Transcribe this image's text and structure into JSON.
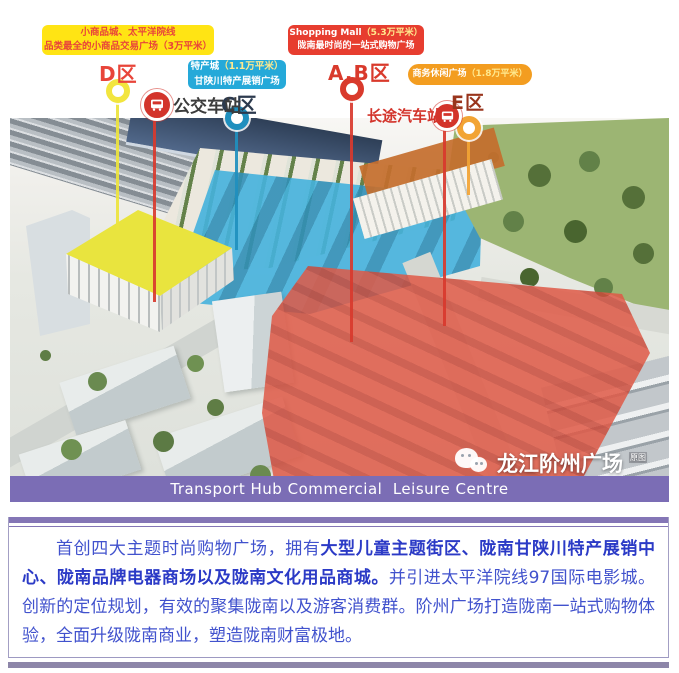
{
  "header_callouts": {
    "small_commodity": {
      "line1": "小商品城、太平洋院线",
      "line2": "品类最全的小商品交易广场（3万平米）",
      "bg": "#ffe414",
      "text_color": "#e8453a"
    },
    "shopping_mall": {
      "name": "Shopping Mall",
      "area": "（5.3万平米）",
      "line2": "陇南最时尚的一站式购物广场",
      "bg": "#e73d2f",
      "text_color": "#ffffff"
    },
    "specialty": {
      "name": "特产城",
      "area": "（1.1万平米）",
      "line2": "甘陕川特产展销广场",
      "bg": "#25a9d9",
      "text_color": "#ffffff"
    },
    "business": {
      "name": "商务休闲广场",
      "area": "（1.8万平米）",
      "bg": "#f39d20",
      "text_color": "#ffffff"
    }
  },
  "zones": {
    "d": {
      "label": "D区",
      "label_color": "#e8453a",
      "marker_color": "#f2e53e"
    },
    "c": {
      "label": "C区",
      "label_color": "#2c3a4e",
      "marker_color": "#1f8fbe"
    },
    "ab": {
      "label": "A.B区",
      "label_color": "#d93a2c",
      "marker_color": "#d93a2c"
    },
    "e": {
      "label": "E区",
      "label_color": "#99351d",
      "marker_color": "#f2a434"
    }
  },
  "stations": {
    "city_bus": {
      "label": "公交车站",
      "icon": "bus-icon",
      "icon_bg": "#d3342b",
      "label_color": "#3c3c3c"
    },
    "coach": {
      "label": "长途汽车站",
      "icon": "bus-icon",
      "icon_bg": "#d3342b",
      "label_color": "#d3342b"
    }
  },
  "photo": {
    "banner_text": "Transport Hub Commercial  Leisure Centre",
    "banner_bg": "#7b6db5",
    "watermark_icon": "wechat-icon",
    "watermark_text": "龙江阶州广场",
    "watermark_suffix": "原图"
  },
  "colors": {
    "accent_red": "#e73d2f",
    "accent_yellow": "#ffe414",
    "accent_cyan": "#25a9d9",
    "accent_orange": "#f39d20",
    "banner_purple": "#7b6db5",
    "desc_border_purple": "#8476b6",
    "desc_blue": "#4152cd",
    "desc_blue_bold": "#2b3ac6"
  },
  "description": {
    "segments": [
      {
        "text": "首创四大主题时尚购物广场，拥有",
        "bold": false
      },
      {
        "text": "大型儿童主题街区、陇南甘陕川特产展销中心、陇南品牌电器商场以及陇南文化用品商城。",
        "bold": true
      },
      {
        "text": "并引进太平洋院线97国际电影城。创新的定位规划，有效的聚集陇南以及游客消费群。阶州广场打造陇南一站式购物体验，全面升级陇南商业，塑造陇南财富极地。",
        "bold": false
      }
    ]
  }
}
